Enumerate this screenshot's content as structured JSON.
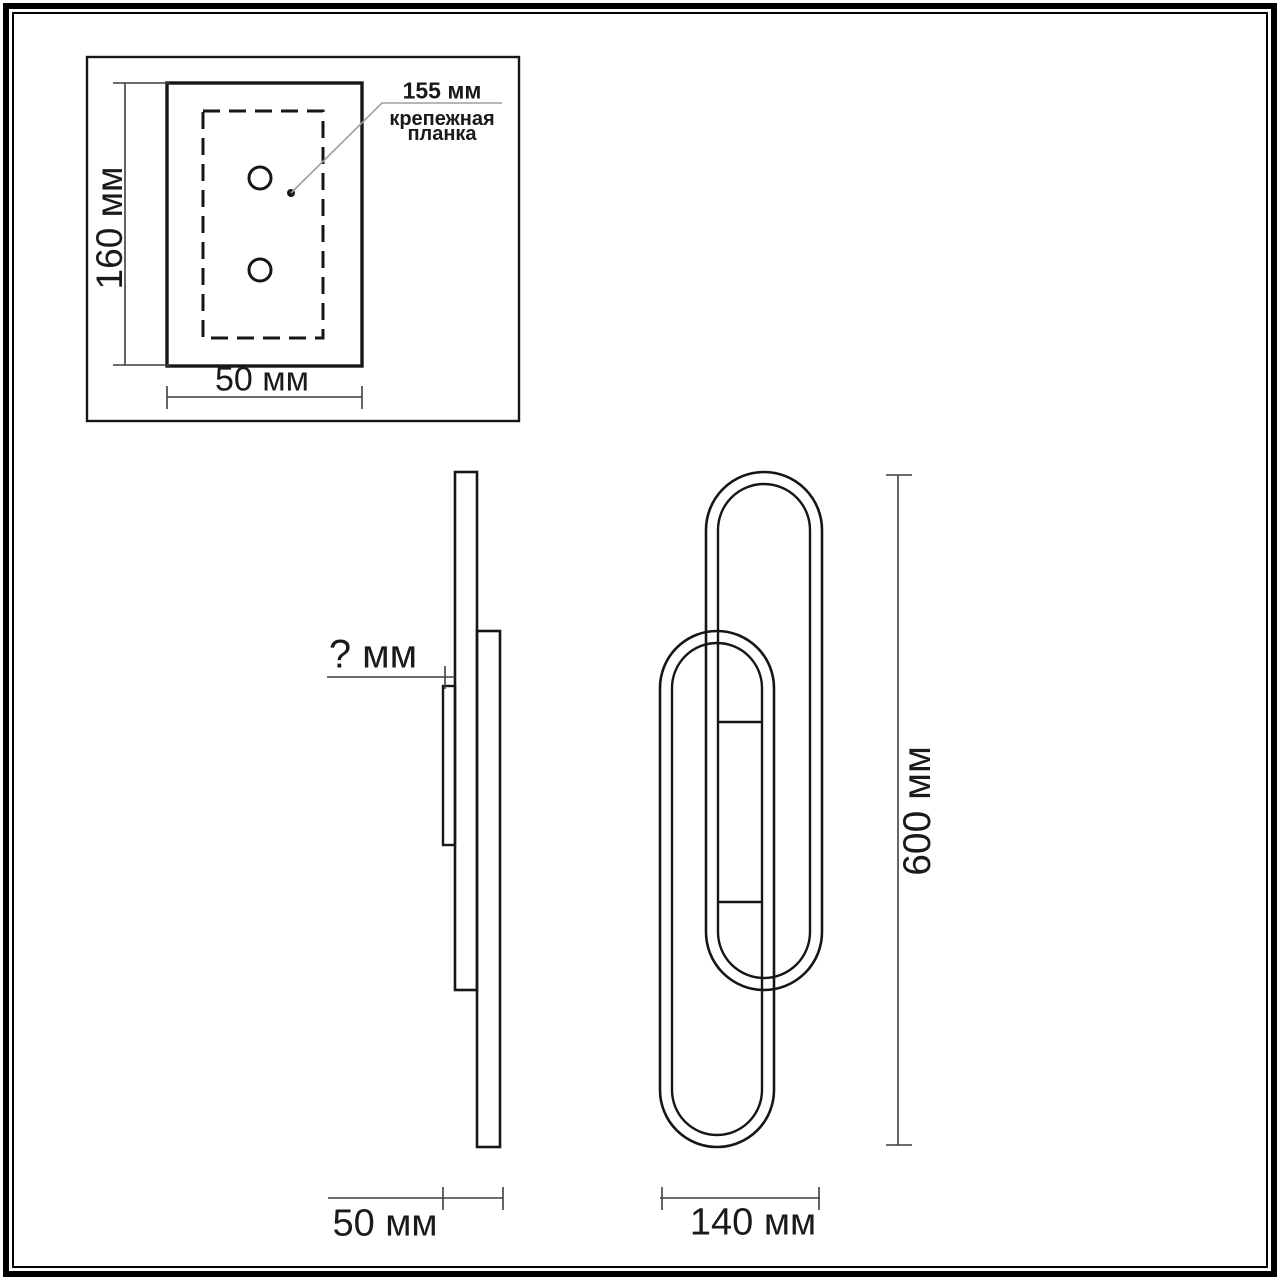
{
  "inset": {
    "height_label": "160 мм",
    "width_label": "50 мм",
    "pitch_label": "155 мм",
    "plate_label_line1": "крепежная",
    "plate_label_line2": "планка"
  },
  "side_view": {
    "depth_unknown_label": "? мм",
    "depth_label": "50 мм"
  },
  "front_view": {
    "height_label": "600 мм",
    "width_label": "140 мм"
  },
  "colors": {
    "outline": "#161616",
    "dimension": "#3f3f3f",
    "leader": "#9e9e9e",
    "text": "#1a1a1a",
    "background": "#ffffff",
    "frame": "#000000"
  }
}
